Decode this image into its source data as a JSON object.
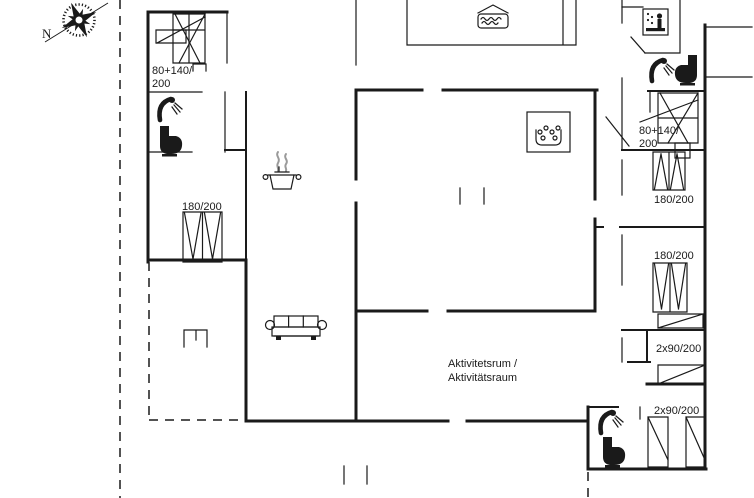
{
  "colors": {
    "background": "#ffffff",
    "line": "#1a1a1a",
    "steam": "#9a9a9a"
  },
  "compass": {
    "north_label": "N"
  },
  "rooms": {
    "activity": {
      "line1": "Aktivitetsrum /",
      "line2": "Aktivitätsraum"
    }
  },
  "beds": {
    "nw_bunk": {
      "line1": "80+140/",
      "line2": "200"
    },
    "w_double": {
      "label": "180/200"
    },
    "ne_bunk": {
      "line1": "80+140/",
      "line2": "200"
    },
    "e_double_upper": {
      "label": "180/200"
    },
    "e_double_lower": {
      "label": "180/200"
    },
    "se_twin_upper": {
      "label": "2x90/200"
    },
    "se_twin_lower": {
      "label": "2x90/200"
    }
  },
  "icons": [
    "compass-rose-icon",
    "whirlpool-tub-icon",
    "spa-bath-icon",
    "sauna-icon",
    "shower-icon",
    "toilet-icon",
    "stove-pot-icon",
    "sofa-icon",
    "grill-icon",
    "bunk-bed-icon",
    "double-bed-icon",
    "single-bed-icon",
    "dresser-icon"
  ]
}
